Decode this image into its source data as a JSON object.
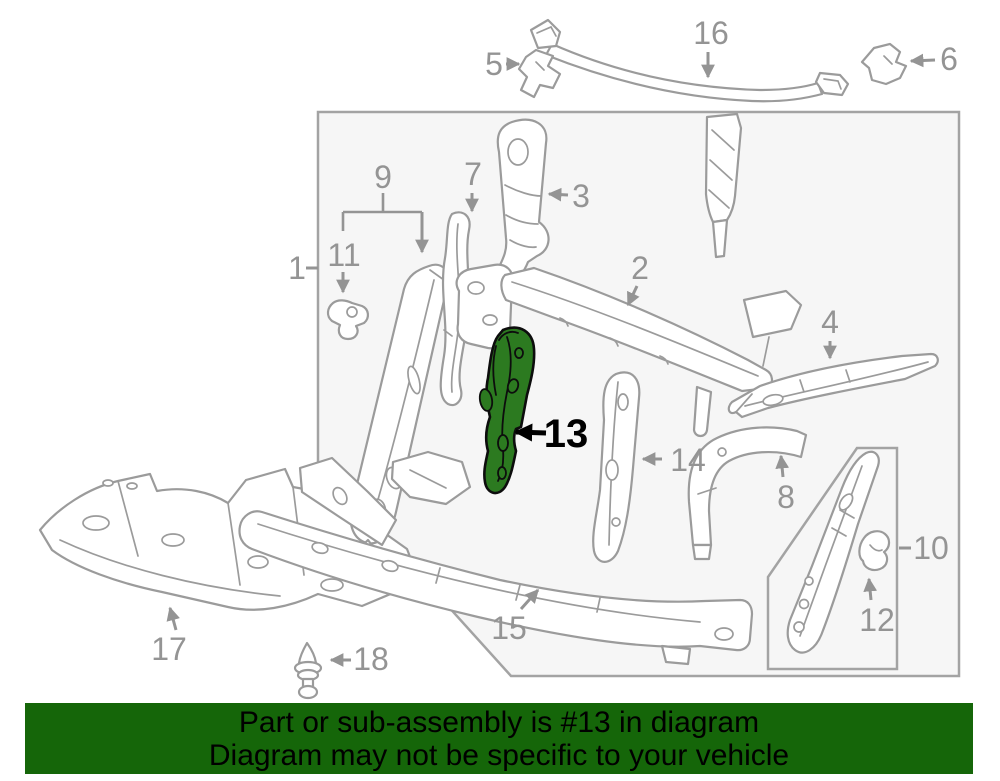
{
  "image": {
    "width": 1000,
    "height": 781,
    "background": "#ffffff"
  },
  "diagram": {
    "description": "Exploded parts diagram of a front radiator support / bulkhead assembly with numbered callouts",
    "box_fill": "#f6f6f6",
    "box_stroke": "#a3a3a3",
    "part_line_color": "#9b9b9b",
    "label_color": "#949494",
    "labels": [
      "1",
      "2",
      "3",
      "4",
      "5",
      "6",
      "7",
      "8",
      "9",
      "10",
      "11",
      "12",
      "13",
      "14",
      "15",
      "16",
      "17",
      "18"
    ],
    "highlighted": {
      "number": "13",
      "fill_color": "#2c7a20",
      "outline_color": "#0d0d0d",
      "label_color": "#000000"
    }
  },
  "banner": {
    "line1": "Part or sub-assembly is #13 in diagram",
    "line2": "Diagram may not be specific to your vehicle",
    "background": "#156609",
    "text_color": "#000000"
  }
}
